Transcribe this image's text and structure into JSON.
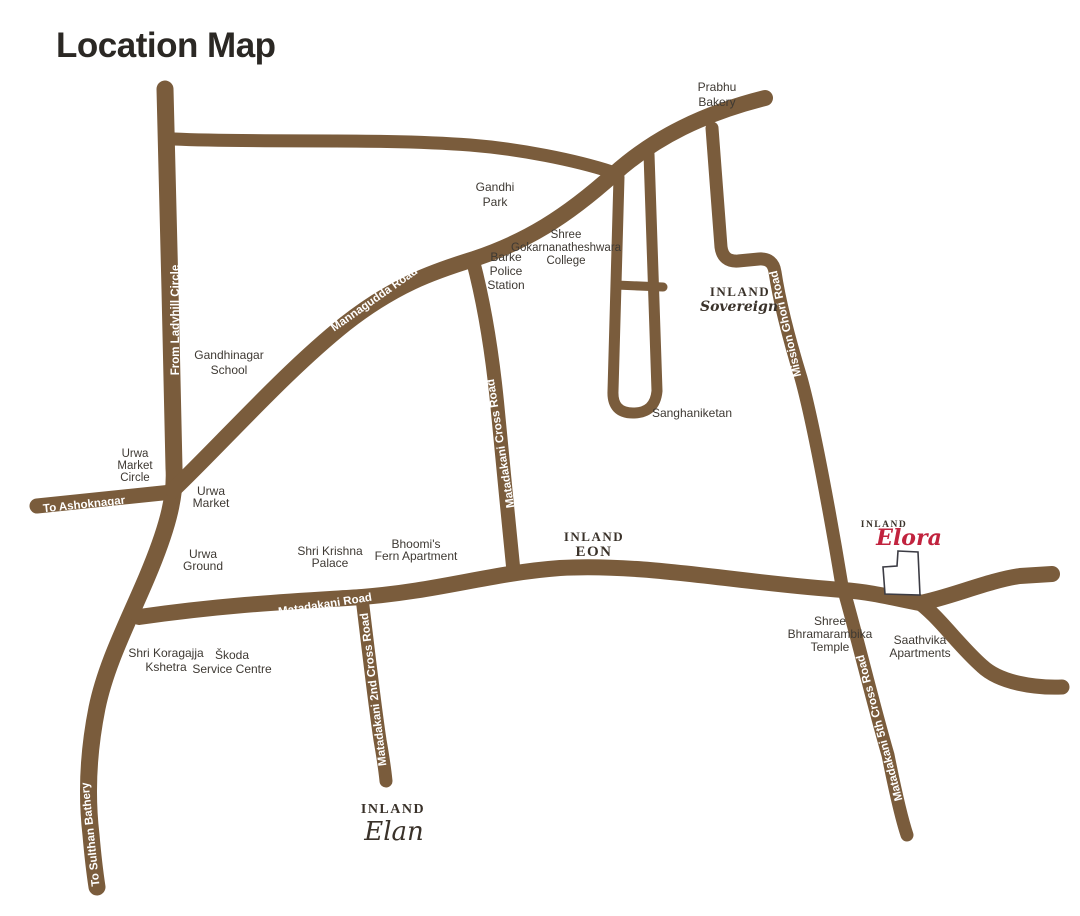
{
  "title": "Location Map",
  "colors": {
    "road": "#7a5c3c",
    "road_label": "#ffffff",
    "place_label": "#3e3933",
    "title": "#2b2824",
    "brand_dark": "#3a322a",
    "elora_red": "#c1233e",
    "site_outline": "#3c3c44",
    "background": "#ffffff"
  },
  "roads": {
    "from_ladyhill_circle": "From Ladyhill Circle",
    "mannagudda_road": "Mannagudda Road",
    "to_ashoknagar": "To Ashoknagar",
    "matadakani_road": "Matadakani Road",
    "matadakani_cross_road": "Matadakani Cross Road",
    "mission_ghori_road": "Mission Ghori Road",
    "matadakani_2nd_cross_road": "Matadakani 2nd Cross Road",
    "matadakani_5th_cross_road": "Matadakani 5th Cross Road",
    "to_sulthan_bathery": "To Sulthan Bathery"
  },
  "places": {
    "prabhu_bakery": [
      "Prabhu",
      "Bakery"
    ],
    "gandhi_park": [
      "Gandhi",
      "Park"
    ],
    "gokarnanatheshwara_college": [
      "Shree",
      "Gokarnanatheshwara",
      "College"
    ],
    "barke_police_station": [
      "Barke",
      "Police",
      "Station"
    ],
    "gandhinagar_school": [
      "Gandhinagar",
      "School"
    ],
    "sanghaniketan": [
      "Sanghaniketan"
    ],
    "urwa_market_circle": [
      "Urwa",
      "Market",
      "Circle"
    ],
    "urwa_market": [
      "Urwa",
      "Market"
    ],
    "urwa_ground": [
      "Urwa",
      "Ground"
    ],
    "shri_krishna_palace": [
      "Shri Krishna",
      "Palace"
    ],
    "bhoomis_fern_apartment": [
      "Bhoomi's",
      "Fern Apartment"
    ],
    "shri_koragajja_kshetra": [
      "Shri Koragajja",
      "Kshetra"
    ],
    "skoda_service_centre": [
      "Škoda",
      "Service Centre"
    ],
    "shree_bhramarambika_temple": [
      "Shree",
      "Bhramarambika",
      "Temple"
    ],
    "saathvika_apartments": [
      "Saathvika",
      "Apartments"
    ]
  },
  "projects": {
    "sovereign": {
      "brand": "INLAND",
      "name": "Sovereign"
    },
    "eon": {
      "brand": "INLAND",
      "name": "EON"
    },
    "elora": {
      "brand": "INLAND",
      "name": "Elora"
    },
    "elan": {
      "brand": "INLAND",
      "name": "Elan"
    }
  }
}
